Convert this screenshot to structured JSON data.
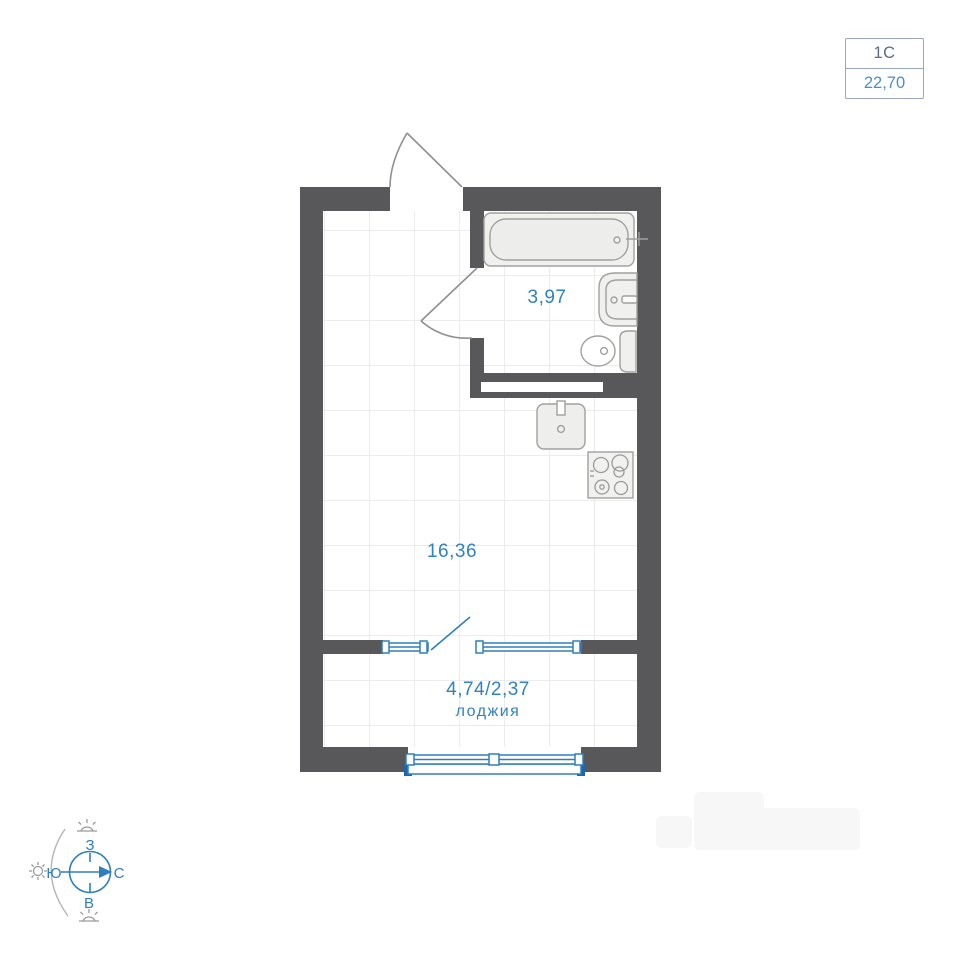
{
  "unit_badge": {
    "type_label": "1С",
    "area_label": "22,70"
  },
  "floorplan": {
    "bathroom": {
      "area": "3,97"
    },
    "living_room": {
      "area": "16,36"
    },
    "loggia": {
      "area": "4,74/2,37",
      "name": "лоджия"
    }
  },
  "compass": {
    "north_label": "С",
    "south_label": "Ю",
    "west_label": "З",
    "east_label": "В"
  },
  "colors": {
    "wall": "#58585a",
    "plan_text_blue": "#3182c3",
    "window_blue": "#2e7fc0",
    "window_solid_blue": "#1b66ad",
    "fixture_stroke": "#a0a09e",
    "fixture_fill": "#f0f0ee",
    "door_stroke": "#909090",
    "grid_line": "#ececec",
    "badge_border": "#96a7bf",
    "badge_type_color": "#5d6b82",
    "badge_area_color": "#4a8fca",
    "compass_blue": "#2e7fc0",
    "compass_gray": "#9a9a9a"
  },
  "icons": {
    "bathtub": "inline-svg-shape",
    "bathroom_sink": "inline-svg-shape",
    "toilet": "inline-svg-shape",
    "kitchen_sink": "inline-svg-shape",
    "stove": "inline-svg-shape",
    "entrance_door_arc": "inline-svg-shape",
    "bathroom_door_arc": "inline-svg-shape",
    "balcony_door_leaf": "inline-svg-shape",
    "window": "inline-svg-shape",
    "sun": "inline-svg-shape",
    "compass_rose": "inline-svg-shape"
  }
}
